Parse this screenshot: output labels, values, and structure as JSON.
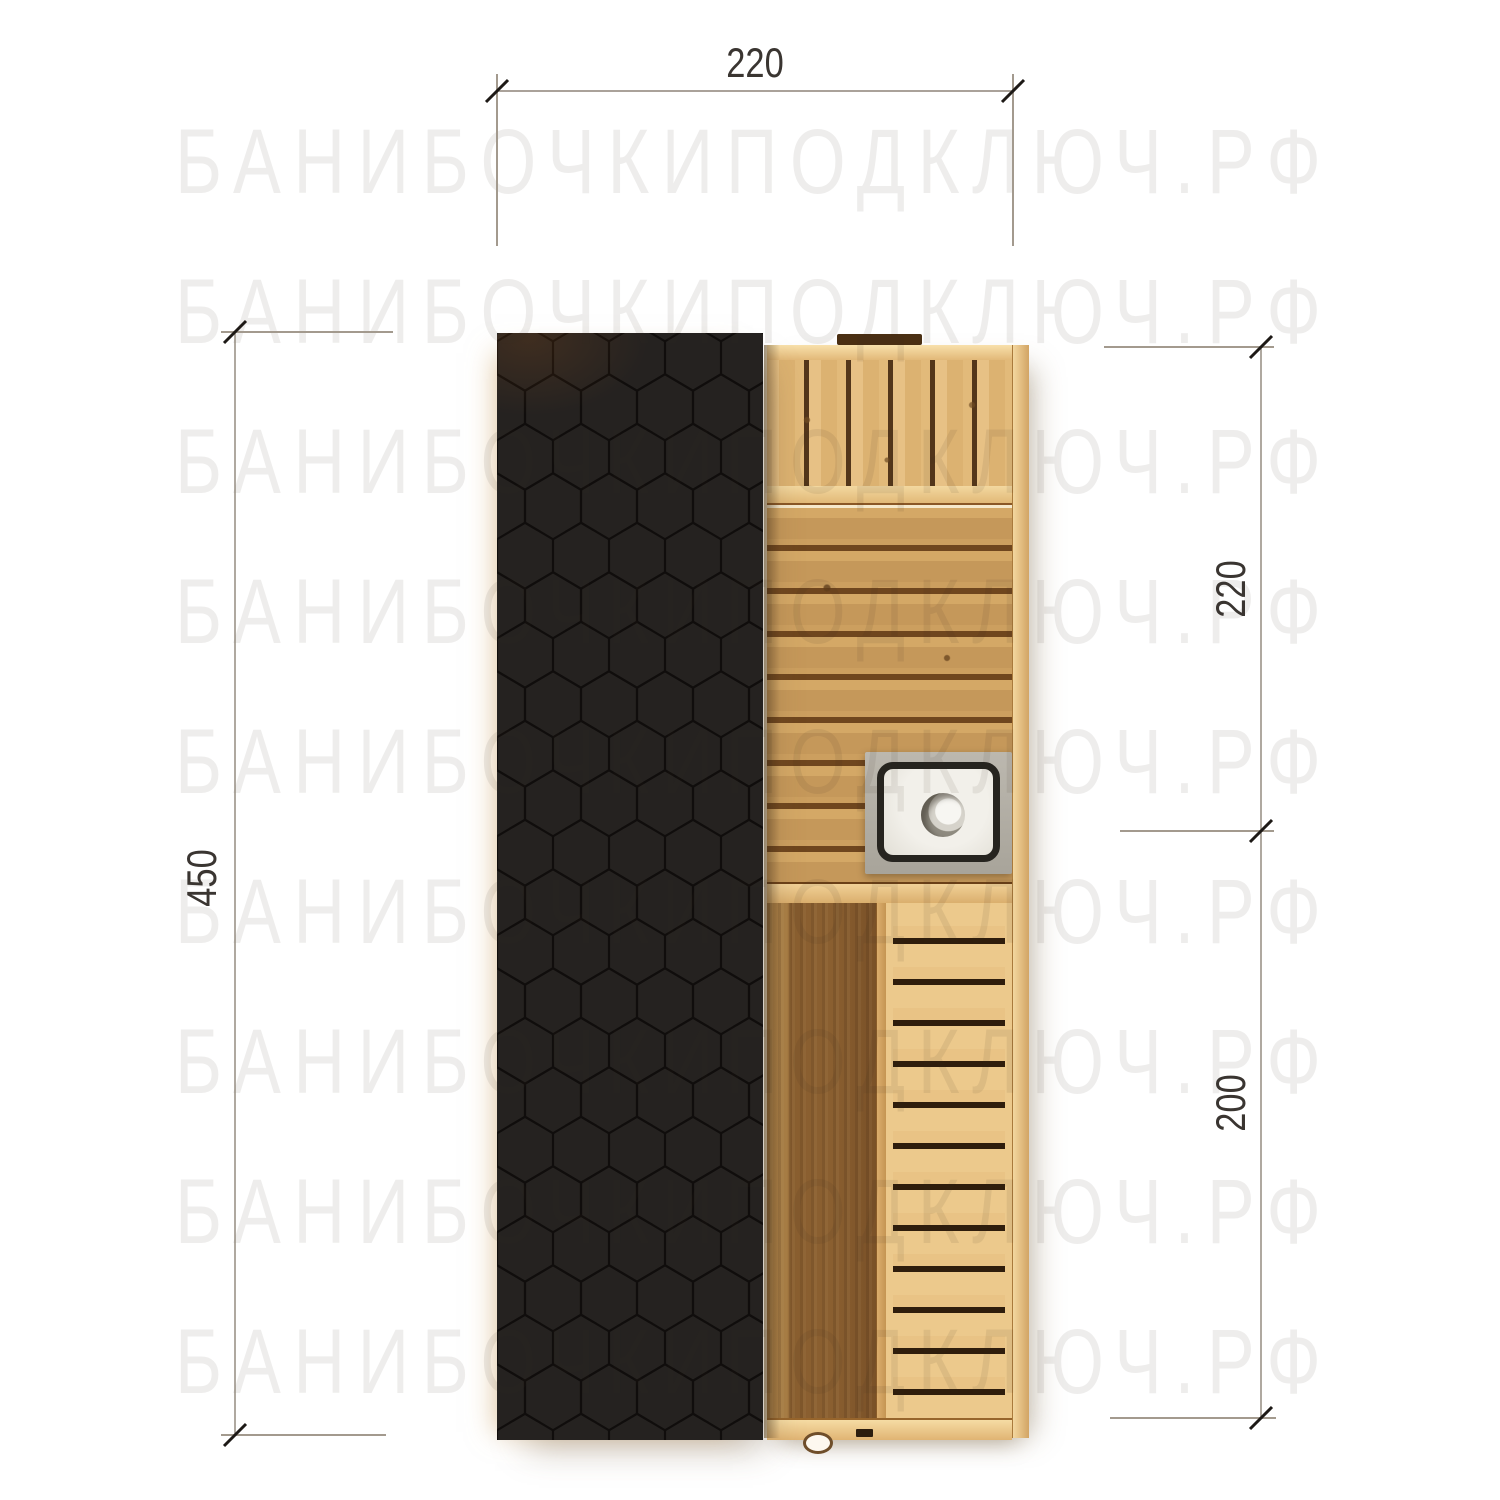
{
  "watermark": {
    "text": "БАНИБОЧКИПОДКЛЮЧ.РФ",
    "rows": 9,
    "color": "#ecebe9"
  },
  "drawing": {
    "type": "floor-plan-top-view",
    "subject": "barrel-sauna-plan",
    "dimensions": {
      "top": {
        "label": "220"
      },
      "left": {
        "label": "450"
      },
      "right_upper": {
        "label": "220"
      },
      "right_lower": {
        "label": "200"
      }
    },
    "colors": {
      "roof": "#252220",
      "roof_pattern_line": "#0d0b09",
      "wall_wood": "#f0d29b",
      "bench_wood": "#e0b87a",
      "bench_gap": "#53361a",
      "floor_wood": "#c99c5c",
      "floor_seam": "#6f461e",
      "entrance_wood": "#8a5f30",
      "deck_wood": "#ecc98c",
      "deck_gap": "#2f1d0c",
      "stove_tray": "#b4b0a7",
      "stove_rim": "#26241f",
      "stove_top": "#f2f0ea",
      "dim_line": "#8d8478",
      "dim_tick": "#1d1916",
      "dim_text": "#3a3531"
    }
  }
}
